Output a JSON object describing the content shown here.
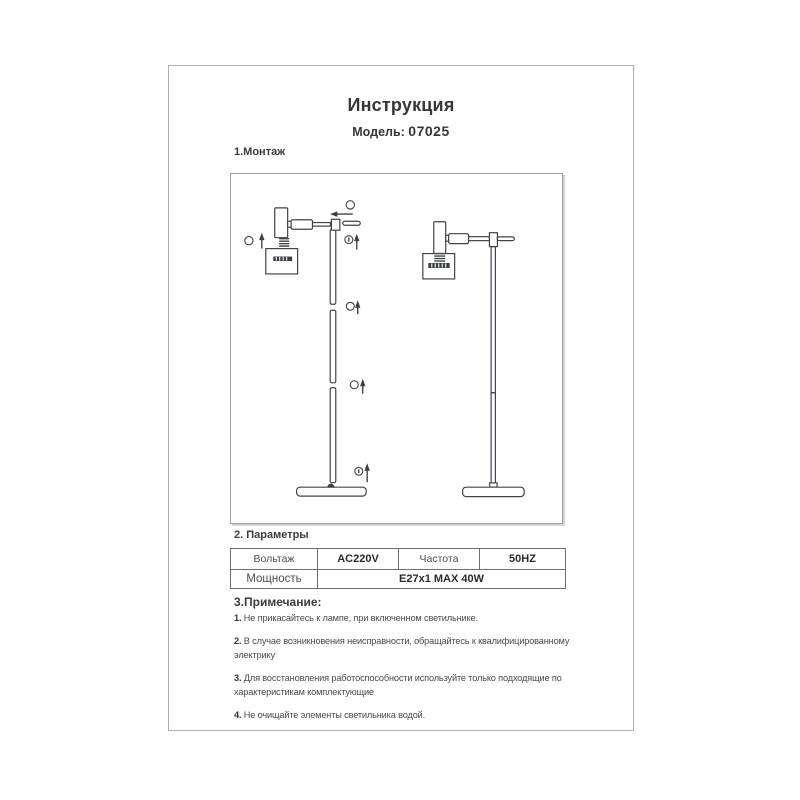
{
  "page": {
    "title": "Инструкция",
    "model_label": "Модель:",
    "model_value": "07025"
  },
  "sections": {
    "montage": "1.Монтаж",
    "params": "2. Параметры",
    "notes": "3.Примечание:"
  },
  "params_table": {
    "rows": [
      [
        "Вольтаж",
        "AC220V",
        "Частота",
        "50HZ"
      ],
      [
        "Мощность",
        "E27x1 MAX 40W"
      ]
    ]
  },
  "notes": [
    {
      "num": "1.",
      "text": "Не прикасайтесь к лампе, при включенном светильнике."
    },
    {
      "num": "2.",
      "text": "В случае возникновения неисправности, обращайтесь к квалифицированному\nэлектрику"
    },
    {
      "num": "3.",
      "text": "Для восстановления работоспособности используйте только подходящие по\nхарактеристикам комплектующие"
    },
    {
      "num": "4.",
      "text": "Не очищайте элементы светильника водой."
    }
  ],
  "diagram": {
    "figures": [
      "exploded-floor-lamp-view",
      "assembled-floor-lamp-view"
    ],
    "callout_icons": [
      "callout-circle",
      "arrow-up-icon",
      "arrow-left-icon"
    ],
    "line_color": "#41434c"
  },
  "colors": {
    "page_border": "#adb0b5",
    "diagram_border": "#9aa0a6",
    "table_border": "#6f6f6f",
    "text": "#3c3c3c"
  }
}
